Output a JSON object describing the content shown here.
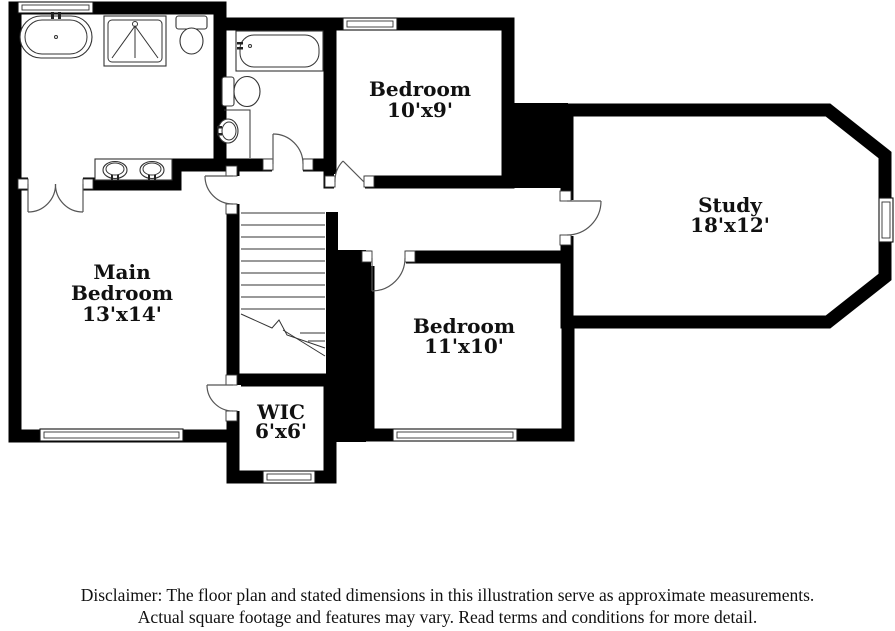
{
  "floor_plan": {
    "rooms": [
      {
        "name_lines": [
          "Main",
          "Bedroom"
        ],
        "dimensions": "13'x14'"
      },
      {
        "name_lines": [
          "Bedroom"
        ],
        "dimensions": "10'x9'"
      },
      {
        "name_lines": [
          "Bedroom"
        ],
        "dimensions": "11'x10'"
      },
      {
        "name_lines": [
          "Study"
        ],
        "dimensions": "18'x12'"
      },
      {
        "name_lines": [
          "WIC"
        ],
        "dimensions": "6'x6'"
      }
    ],
    "fixtures": [
      "freestanding-bathtub",
      "shower",
      "toilet",
      "double-sink-vanity",
      "alcove-bathtub",
      "toilet",
      "pedestal-sink",
      "staircase"
    ],
    "colors": {
      "wall": "#000000",
      "floor": "#ffffff",
      "fixture_line": "#333333",
      "label_text": "#111111"
    }
  },
  "disclaimer": {
    "line1": "Disclaimer: The floor plan and stated dimensions in this illustration serve as approximate measurements.",
    "line2": "Actual square footage and features may vary. Read terms and conditions for more detail."
  }
}
